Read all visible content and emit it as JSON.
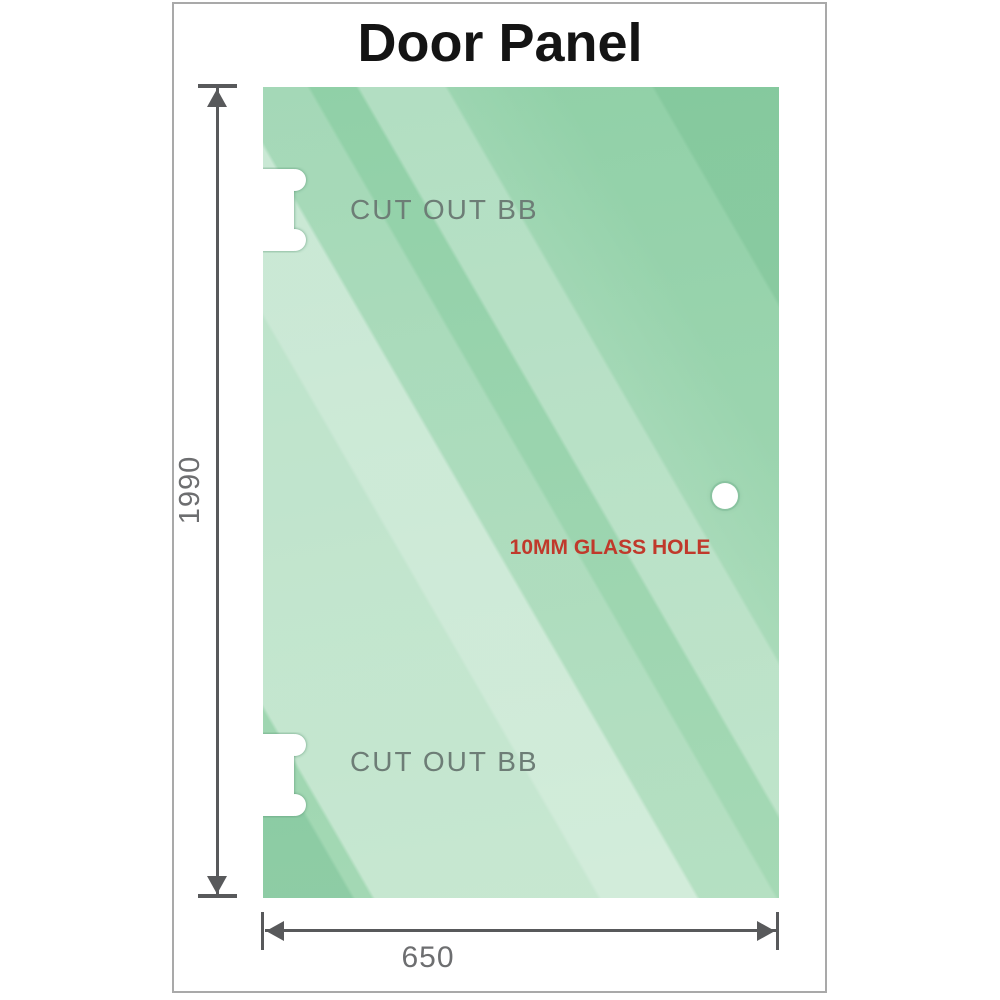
{
  "title": "Door Panel",
  "panel": {
    "cutouts": [
      {
        "label": "CUT OUT BB"
      },
      {
        "label": "CUT OUT BB"
      }
    ],
    "hole": {
      "label": "10MM GLASS HOLE"
    }
  },
  "dimensions": {
    "height": "1990",
    "width": "650"
  },
  "colors": {
    "glass_green_dark": "#8fcfa5",
    "glass_green_light": "#c6e7d0",
    "dimension_line": "#58595b",
    "dimension_text": "#6d6e70",
    "cutout_text": "#6d7d76",
    "hole_label_text": "#c0392b",
    "frame_border": "#a9a9a9",
    "title_text": "#141414"
  }
}
